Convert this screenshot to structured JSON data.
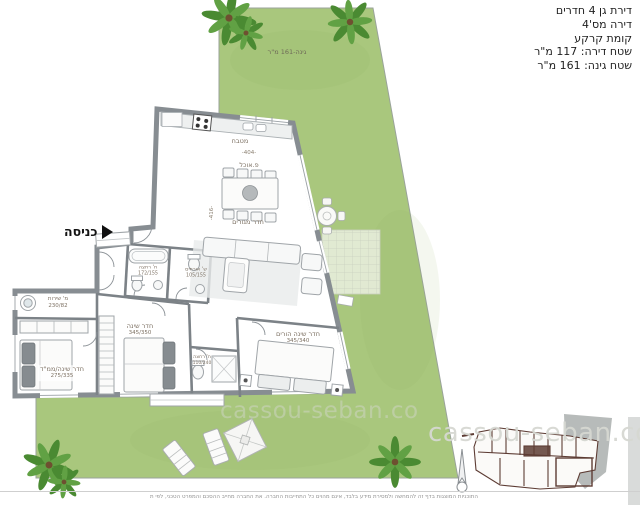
{
  "header": {
    "line1": "דירת גן 4 חדרים",
    "line2": "דירה מס'4",
    "line3": "קומת קרקע",
    "line4": "שטח דירה: 117 מ\"ר",
    "line5": "שטח גינה: 161 מ\"ר"
  },
  "garden": {
    "label": "גינה-161 מ\"ר"
  },
  "entrance": {
    "label": "כניסה"
  },
  "rooms": {
    "kitchen": {
      "label": "מטבח"
    },
    "dining": {
      "label": "פ.אוכל",
      "dim": "-404-"
    },
    "living": {
      "label": "חדר מגורים",
      "dim": "-416-"
    },
    "guest_bath": {
      "label": "ח' רחצה",
      "size": "172/155"
    },
    "guest_wc": {
      "label": "ש' אורחים",
      "size": "105/155"
    },
    "service": {
      "label": "מ' שירות",
      "size": "230/82"
    },
    "bedroom_mamad": {
      "label": "חדר שינה/ממ\"ד",
      "size": "275/335"
    },
    "bedroom2": {
      "label": "חדר שינה",
      "size": "345/350"
    },
    "master_bath": {
      "label": "ח' רחצה",
      "size": "110/240"
    },
    "master_bedroom": {
      "label": "חדר שינה הורים",
      "size": "345/340"
    }
  },
  "watermark": "cassou-seban.co",
  "disclaimer": "התוכניות המוצגות בדף זה להמחשה ולמסירת מידע בלבד, אינם מהוים כל התחייבות החברה. את החברה מחייב ההסכם והמפרט הטכני, לפי ת",
  "colors": {
    "garden": "#a9c77d",
    "walls": "#878d92",
    "keyplan": "#5d3c34"
  }
}
